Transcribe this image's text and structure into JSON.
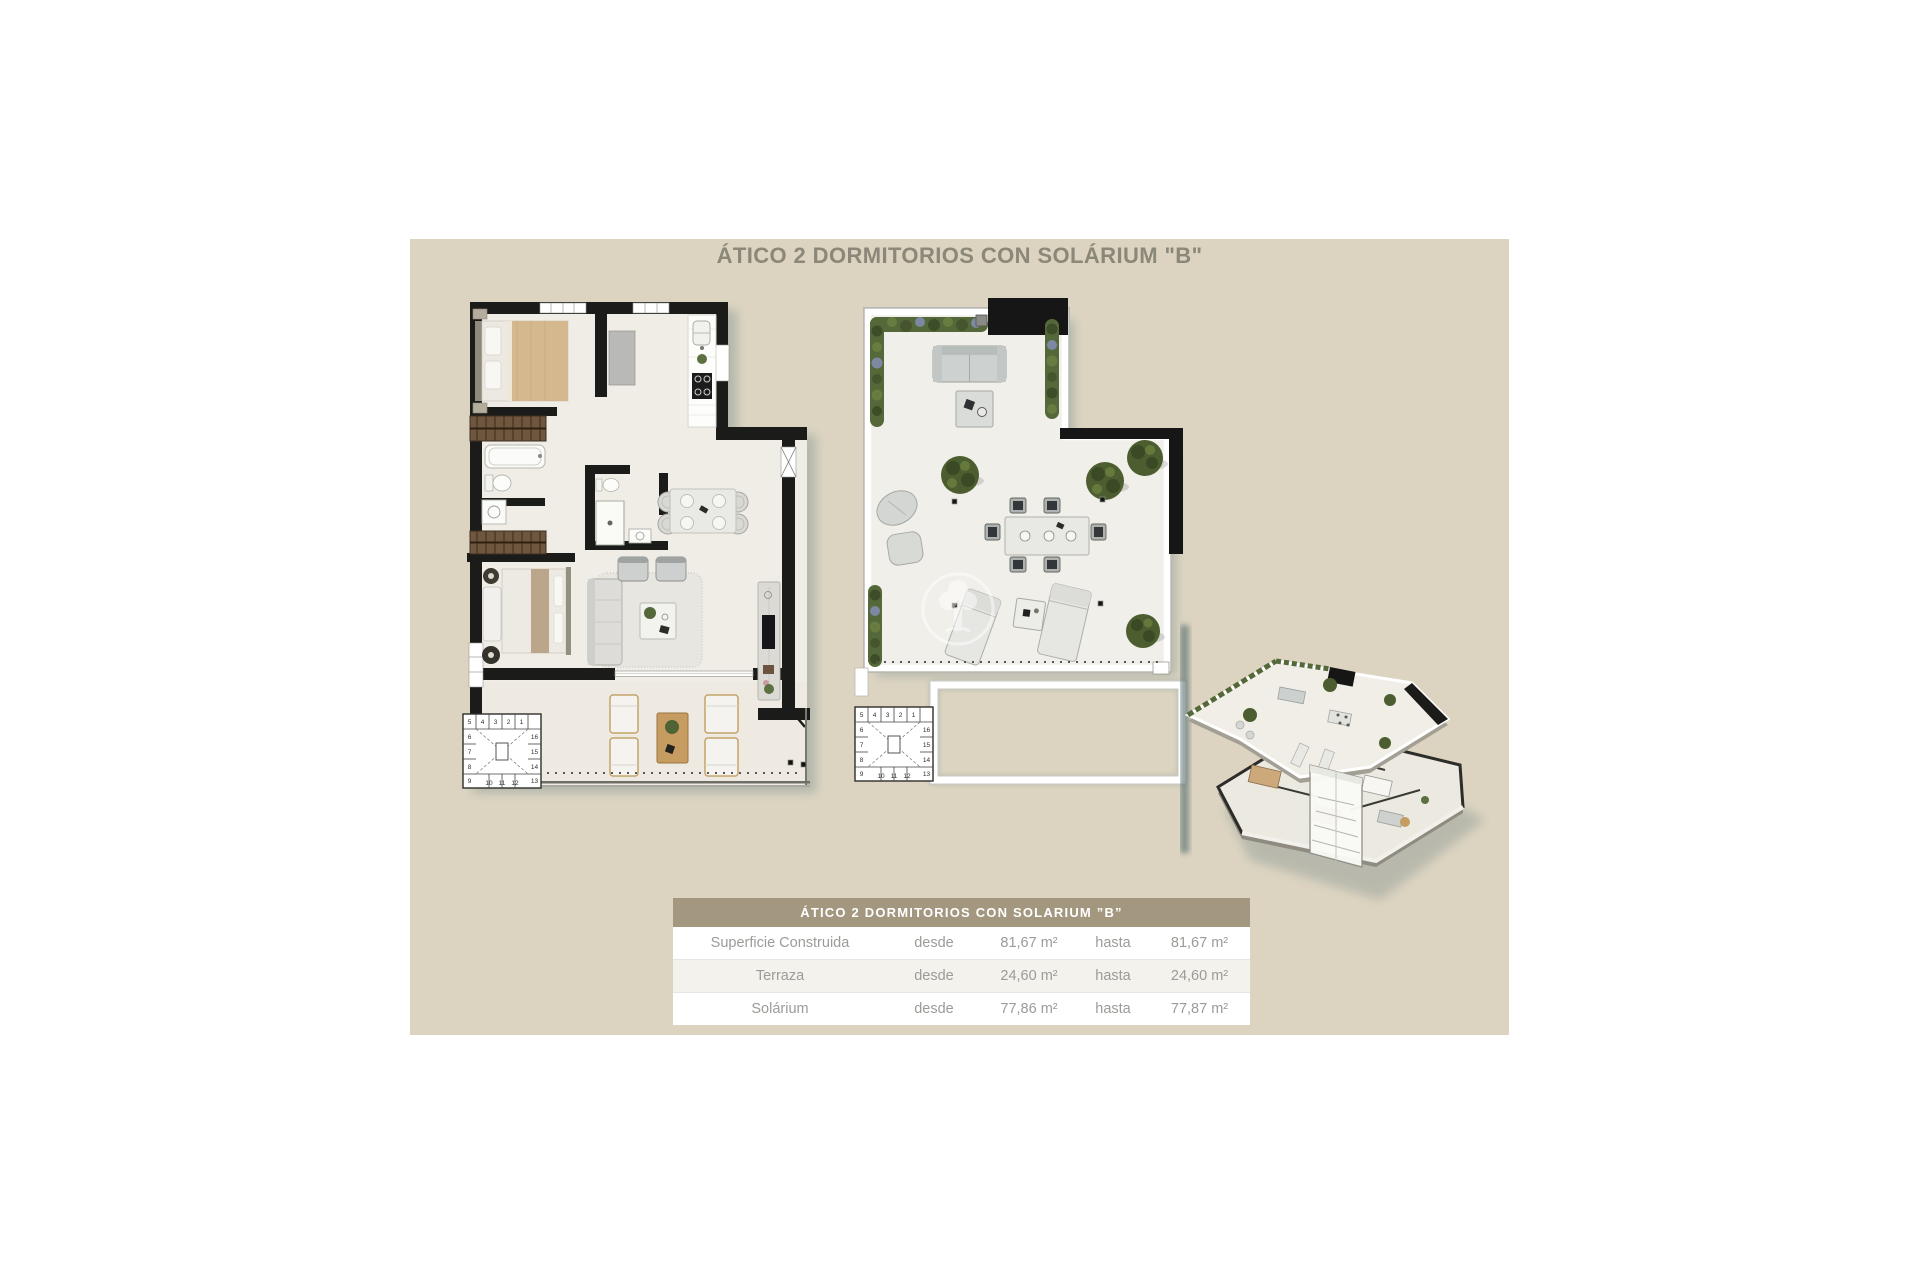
{
  "title": "ÁTICO 2 DORMITORIOS CON SOLÁRIUM \"B\"",
  "table": {
    "header": "ÁTICO 2 DORMITORIOS CON SOLARIUM ”B”",
    "rows": [
      {
        "label": "Superficie Construida",
        "desde_label": "desde",
        "desde_value": "81,67 m²",
        "hasta_label": "hasta",
        "hasta_value": "81,67 m²"
      },
      {
        "label": "Terraza",
        "desde_label": "desde",
        "desde_value": "24,60 m²",
        "hasta_label": "hasta",
        "hasta_value": "24,60 m²"
      },
      {
        "label": "Solárium",
        "desde_label": "desde",
        "desde_value": "77,86 m²",
        "hasta_label": "hasta",
        "hasta_value": "77,87 m²"
      }
    ]
  },
  "stairs": {
    "top": [
      "5",
      "4",
      "3",
      "2",
      "1"
    ],
    "left": [
      "6",
      "7",
      "8",
      "9"
    ],
    "right": [
      "16",
      "15",
      "14",
      "13"
    ],
    "bottom": [
      "10",
      "11",
      "12"
    ]
  },
  "colors": {
    "panel_background": "#dcd4c1",
    "table_header_background": "#a39780",
    "table_alt_row": "#f4f2ed",
    "title_text": "#8b8779",
    "body_text": "#9b9b97",
    "wall": "#1b1b19",
    "floor": "#f0ede6",
    "plant_green": "#4c5e2f"
  }
}
